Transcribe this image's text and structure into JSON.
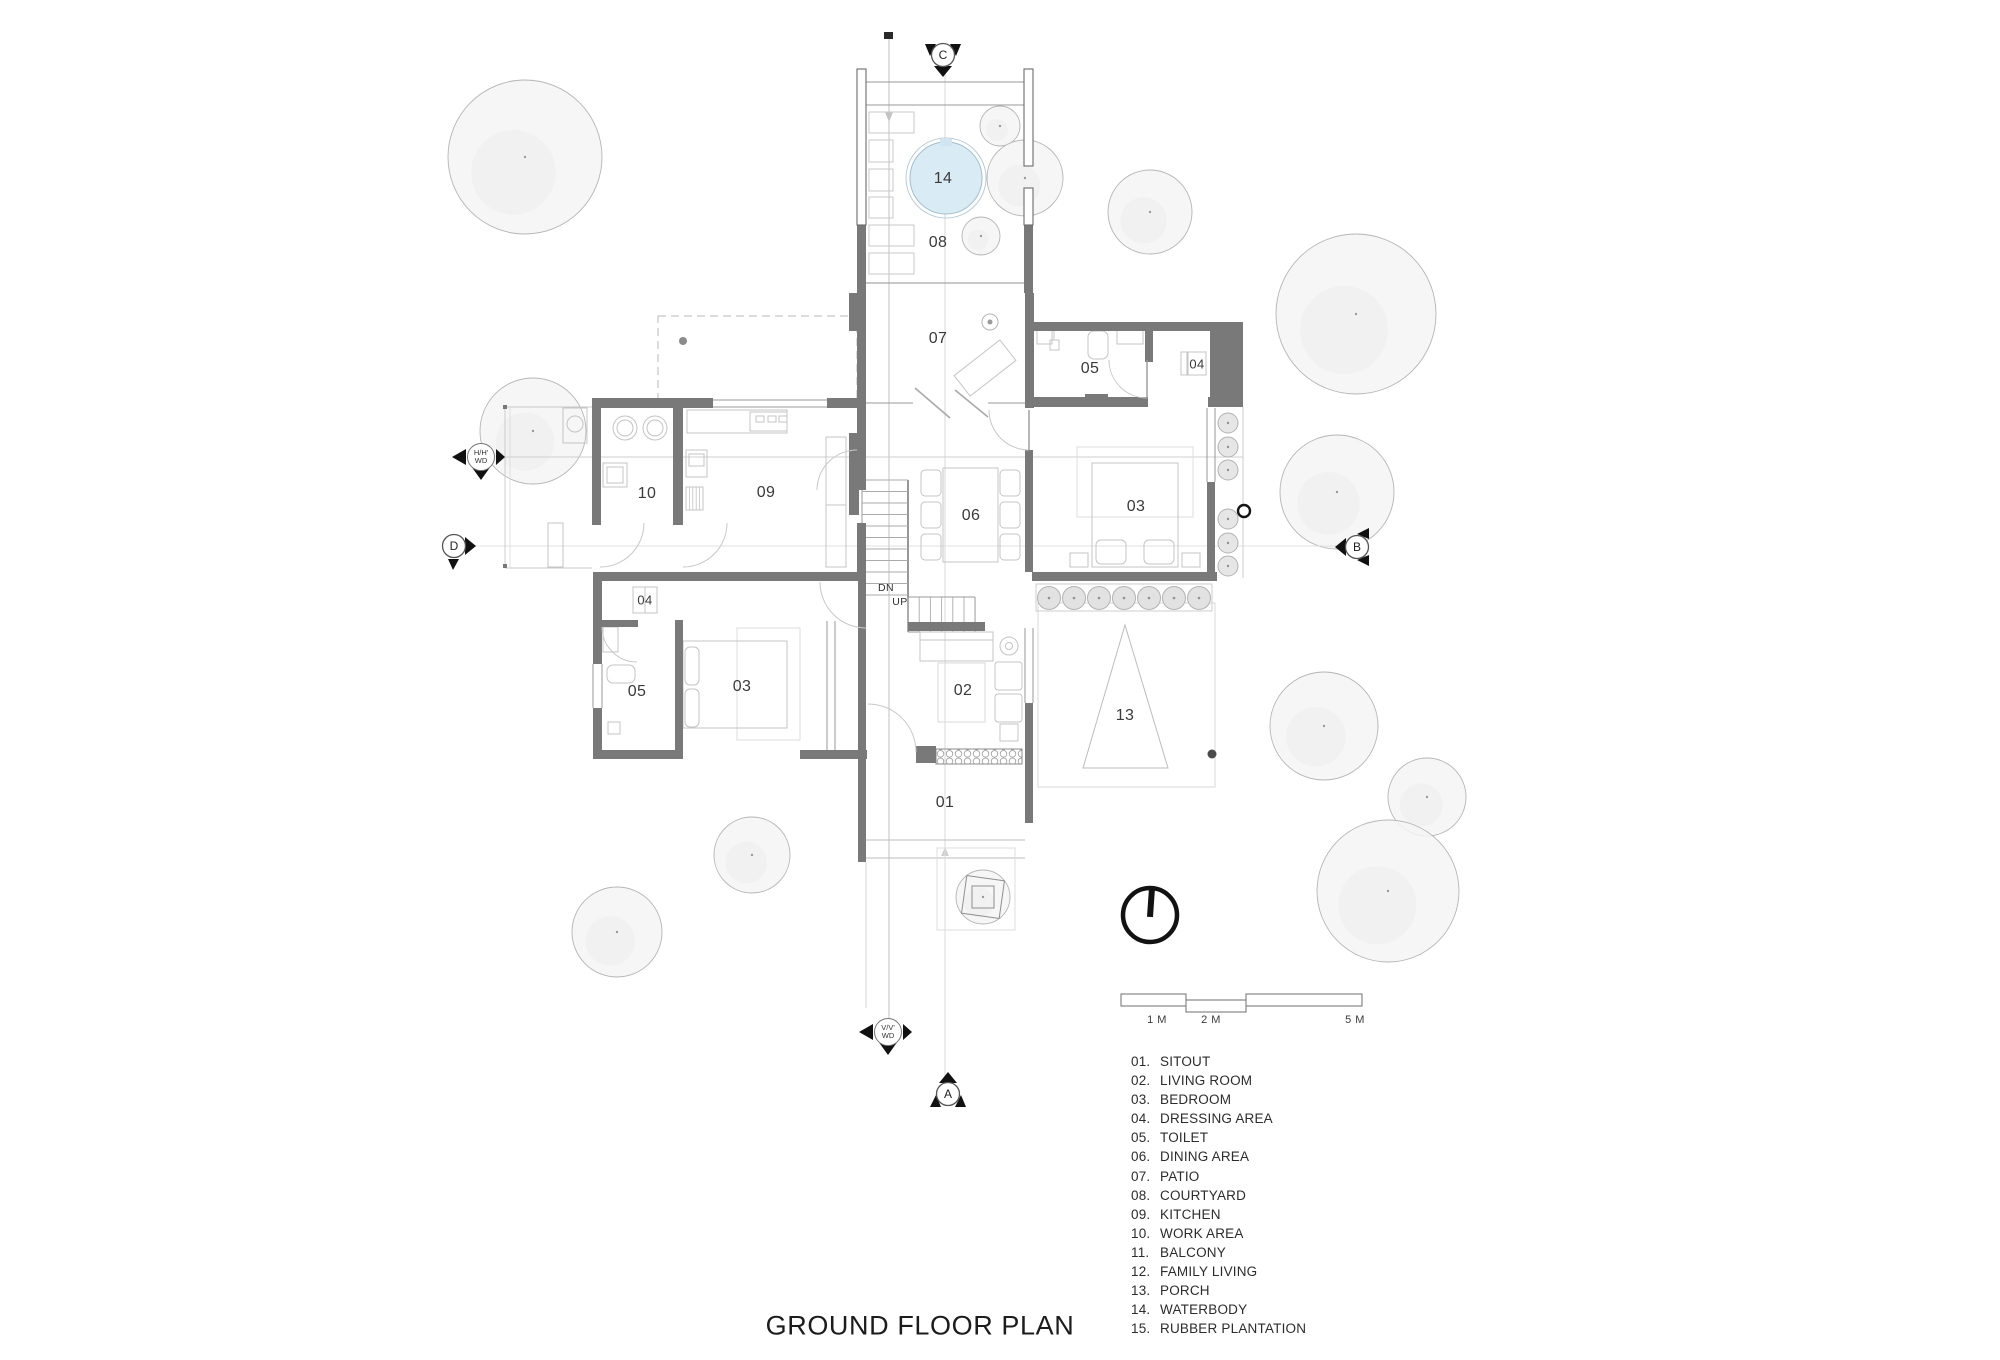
{
  "title": "GROUND FLOOR PLAN",
  "legend": {
    "items": [
      {
        "num": "01.",
        "label": "SITOUT"
      },
      {
        "num": "02.",
        "label": "LIVING ROOM"
      },
      {
        "num": "03.",
        "label": "BEDROOM"
      },
      {
        "num": "04.",
        "label": "DRESSING AREA"
      },
      {
        "num": "05.",
        "label": "TOILET"
      },
      {
        "num": "06.",
        "label": "DINING AREA"
      },
      {
        "num": "07.",
        "label": "PATIO"
      },
      {
        "num": "08.",
        "label": "COURTYARD"
      },
      {
        "num": "09.",
        "label": "KITCHEN"
      },
      {
        "num": "10.",
        "label": "WORK AREA"
      },
      {
        "num": "11.",
        "label": "BALCONY"
      },
      {
        "num": "12.",
        "label": "FAMILY LIVING"
      },
      {
        "num": "13.",
        "label": "PORCH"
      },
      {
        "num": "14.",
        "label": "WATERBODY"
      },
      {
        "num": "15.",
        "label": "RUBBER PLANTATION"
      }
    ]
  },
  "scale_bar": {
    "labels": [
      "1 M",
      "2 M",
      "5 M"
    ]
  },
  "section_markers": {
    "top": "C",
    "bottom": "A",
    "right": "B",
    "left": "D"
  },
  "ref_markers": {
    "horizontal": {
      "line1": "H/H'",
      "line2": "WD"
    },
    "vertical": {
      "line1": "V/V'",
      "line2": "WD"
    }
  },
  "stairs": {
    "down": "DN",
    "up": "UP"
  },
  "room_labels": [
    {
      "text": "14",
      "x": 943,
      "y": 179,
      "size": "md"
    },
    {
      "text": "08",
      "x": 938,
      "y": 243,
      "size": "md"
    },
    {
      "text": "07",
      "x": 938,
      "y": 339,
      "size": "md"
    },
    {
      "text": "05",
      "x": 1090,
      "y": 369,
      "size": "md"
    },
    {
      "text": "04",
      "x": 1197,
      "y": 364,
      "size": "sm"
    },
    {
      "text": "10",
      "x": 647,
      "y": 494,
      "size": "md"
    },
    {
      "text": "09",
      "x": 766,
      "y": 493,
      "size": "md"
    },
    {
      "text": "06",
      "x": 971,
      "y": 516,
      "size": "md"
    },
    {
      "text": "03",
      "x": 1136,
      "y": 507,
      "size": "md"
    },
    {
      "text": "04",
      "x": 645,
      "y": 600,
      "size": "sm"
    },
    {
      "text": "05",
      "x": 637,
      "y": 692,
      "size": "md"
    },
    {
      "text": "03",
      "x": 742,
      "y": 687,
      "size": "md"
    },
    {
      "text": "02",
      "x": 963,
      "y": 691,
      "size": "md"
    },
    {
      "text": "13",
      "x": 1125,
      "y": 716,
      "size": "md"
    },
    {
      "text": "01",
      "x": 945,
      "y": 803,
      "size": "md"
    },
    {
      "text": "DN",
      "x": 886,
      "y": 588,
      "size": "xs"
    },
    {
      "text": "UP",
      "x": 900,
      "y": 602,
      "size": "xs"
    }
  ],
  "colors": {
    "wall": "#797979",
    "water": "#d9ecf6",
    "tree_fill": "#f5f5f5",
    "furniture_line": "#c4c4c4",
    "text": "#3a3a3a"
  }
}
